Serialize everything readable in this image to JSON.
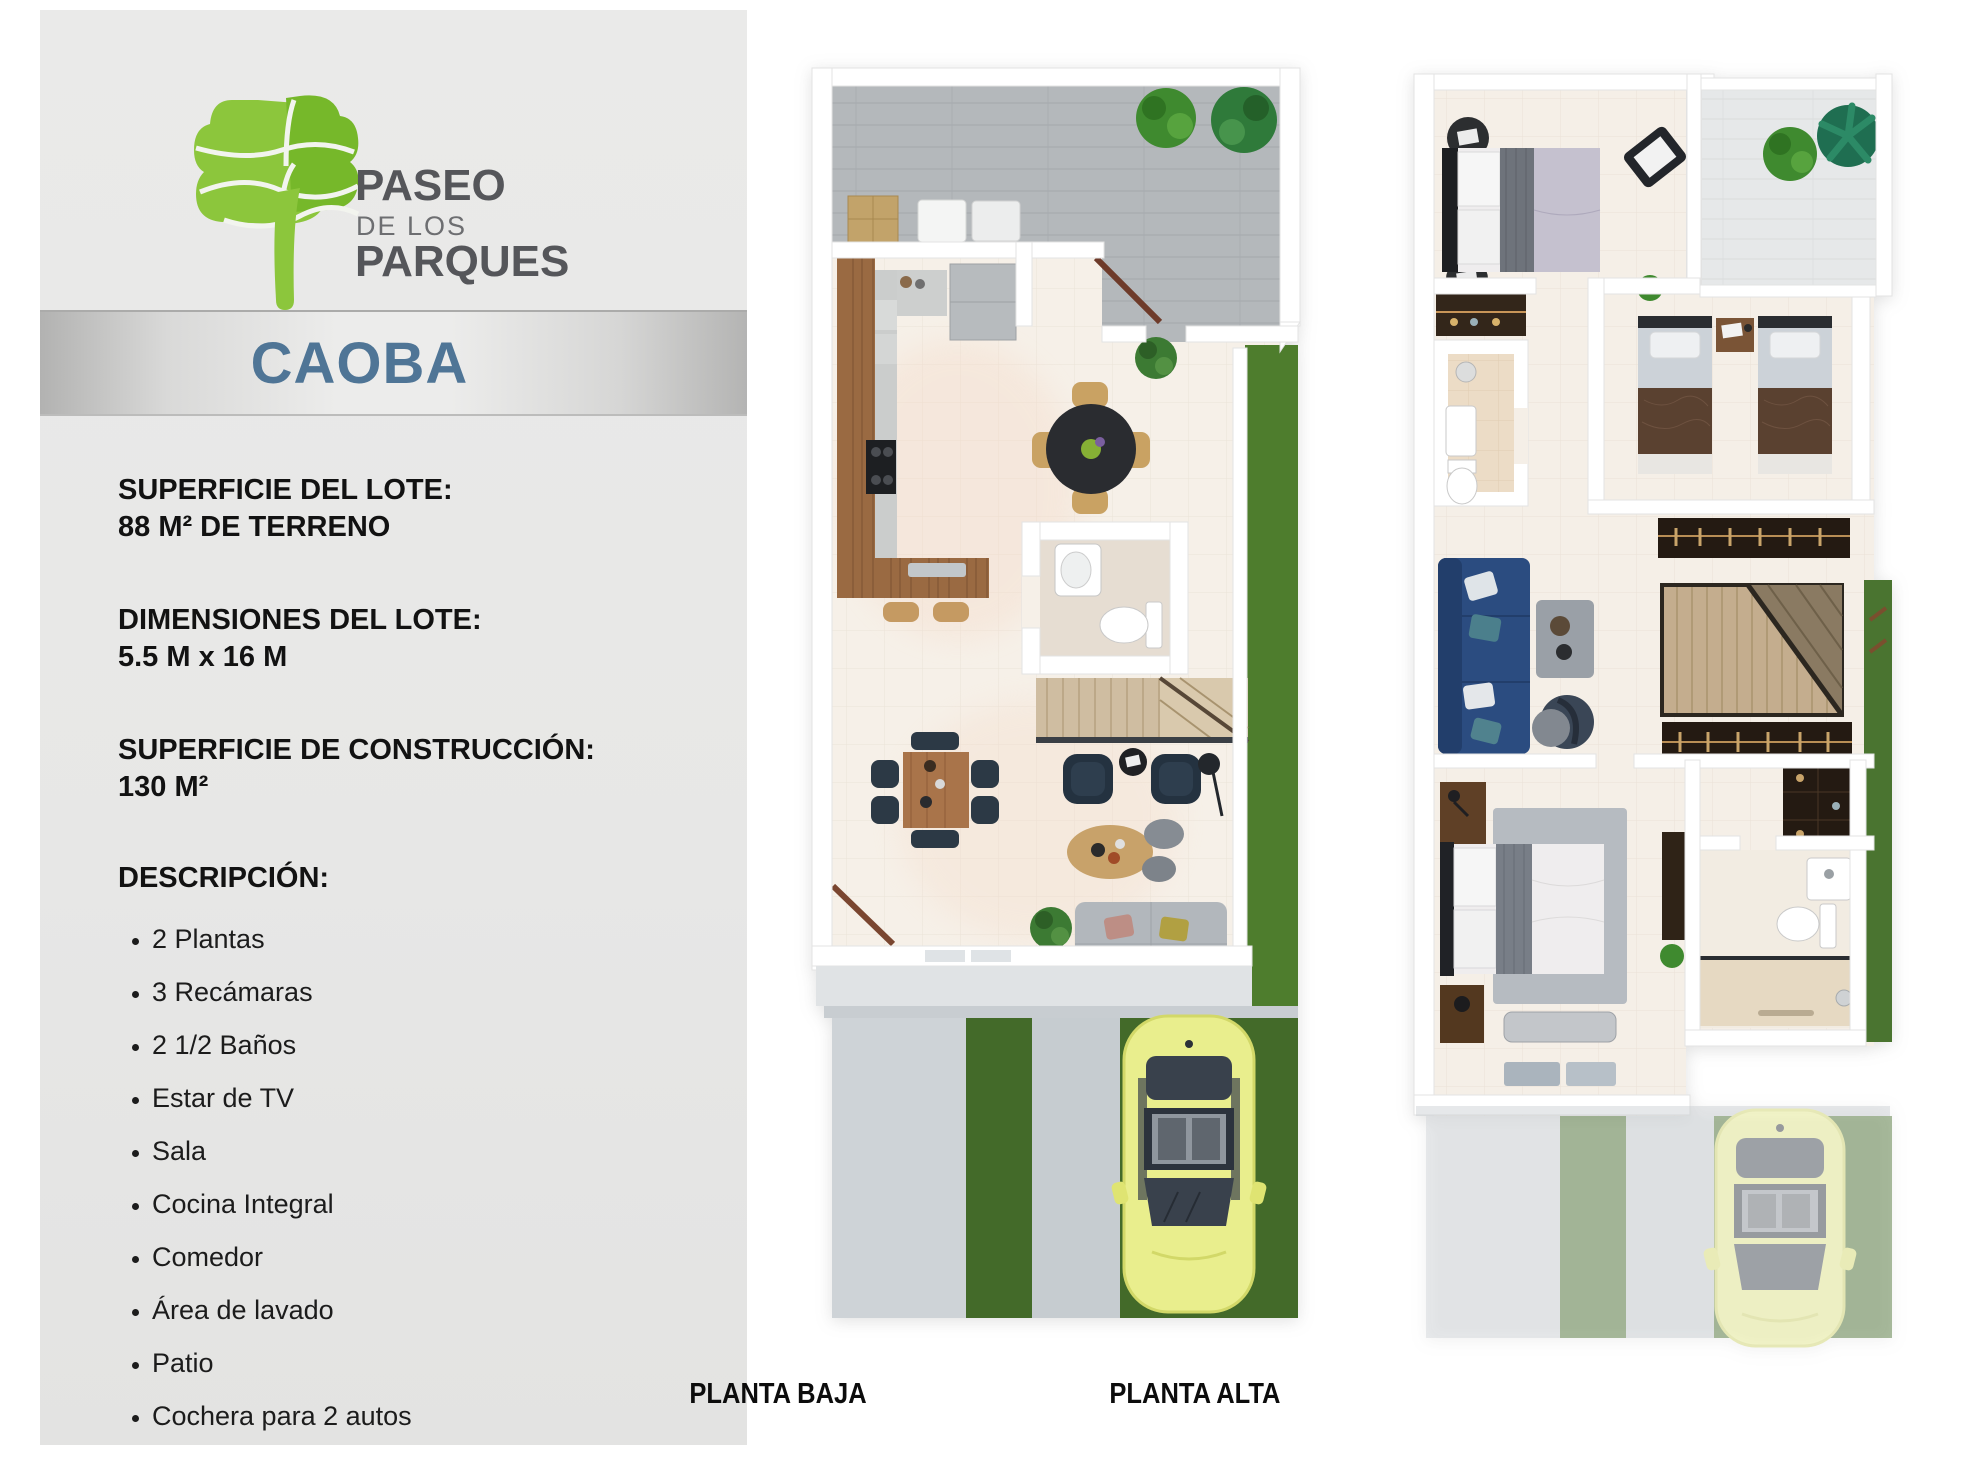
{
  "sidebar": {
    "logo": {
      "word1": "PASEO",
      "word2": "DE LOS",
      "word3": "PARQUES"
    },
    "model_banner": {
      "title": "CAOBA",
      "text_color": "#4f7596"
    },
    "specs": [
      {
        "label": "SUPERFICIE DEL LOTE:",
        "value": "88 M² DE TERRENO"
      },
      {
        "label": "DIMENSIONES DEL LOTE:",
        "value": "5.5 M x 16 M"
      },
      {
        "label": "SUPERFICIE DE CONSTRUCCIÓN:",
        "value": "130 M²"
      }
    ],
    "description": {
      "title": "DESCRIPCIÓN:",
      "items": [
        "2 Plantas",
        "3 Recámaras",
        "2 1/2 Baños",
        "Estar de TV",
        "Sala",
        "Cocina Integral",
        "Comedor",
        "Área de lavado",
        "Patio",
        "Cochera para 2 autos"
      ]
    }
  },
  "plans": {
    "left": {
      "label": "PLANTA BAJA"
    },
    "right": {
      "label": "PLANTA ALTA"
    }
  },
  "colors": {
    "logo_green_light": "#9bcb3c",
    "logo_green_dark": "#74b62c",
    "logo_text": "#58595b",
    "banner_blue": "#4f7596",
    "sidebar_gray": "#e8e8e7",
    "grass_green": "#4a7530",
    "car_yellow": "#e9ee8d",
    "wood_brown": "#9a6a42"
  }
}
